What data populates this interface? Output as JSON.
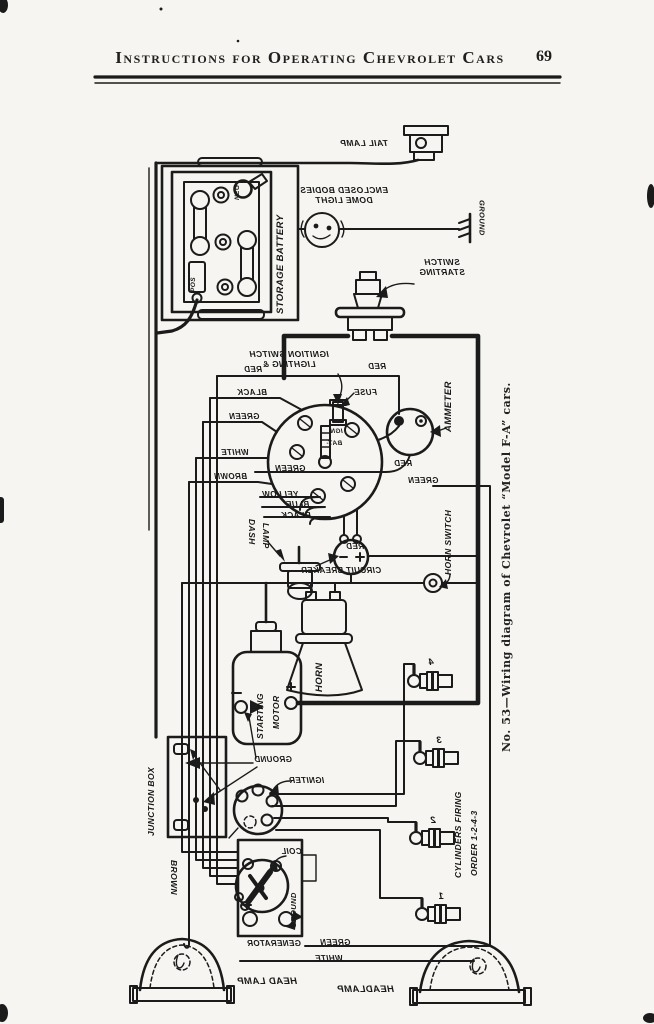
{
  "colors": {
    "ink": "#1b1b1b",
    "paper": "#f6f5f1"
  },
  "header": {
    "title": "Instructions for Operating Chevrolet Cars",
    "page_number": "69"
  },
  "caption": "No. 53—Wiring diagram of Chevrolet “Model F-A” cars.",
  "labels": {
    "tail_lamp": "TAIL LAMP",
    "dome_light": [
      "ENCLOSED BODIES",
      "DOME LIGHT"
    ],
    "ground_top": "GROUND",
    "storage_battery": "STORAGE BATTERY",
    "neg": "NEG",
    "pos": "POS",
    "starting_switch": [
      "SWITCH",
      "STARTING"
    ],
    "ignition_switch": [
      "IGNITION SWITCH",
      "LIGHTING &"
    ],
    "wire_red": "RED",
    "wire_black": "BLACK",
    "wire_green": "GREEN",
    "wire_white": "WHITE",
    "wire_brown": "BROWN",
    "red_fuse_area": "RED",
    "fuse": "FUSE",
    "ign_terminal": "IGN",
    "bat_terminal": "BAT-",
    "ammeter": "AMMETER",
    "red_below_ammeter": "RED",
    "green_right": "GREEN",
    "green_mid": "GREEN",
    "yellow": "YELLOW",
    "blue": "BLUE",
    "black_mid": "BLACK",
    "dash_lamp": [
      "DASH",
      "LAMP"
    ],
    "circuit_breaker": "CIRCUIT BREAKER",
    "red_horn": "RED",
    "horn_switch": "HORN SWITCH",
    "horn": "HORN",
    "starting_motor": [
      "STARTING",
      "MOTOR"
    ],
    "ground_motor": "GROUND",
    "junction_box": "JUNCTION BOX",
    "igniter": "IGNITER",
    "coil": "COIL",
    "ground_generator": "GROUND",
    "generator": "GENERATOR",
    "green_bottom": "GREEN",
    "white_bottom": "WHITE",
    "brown_left": "BROWN",
    "head_lamp_left": "HEAD LAMP",
    "head_lamp_right": "HEADLAMP",
    "cylinders_firing": [
      "CYLINDERS FIRING",
      "ORDER 1-2-4-3"
    ],
    "plug_numbers": [
      "4",
      "3",
      "2",
      "1"
    ]
  }
}
